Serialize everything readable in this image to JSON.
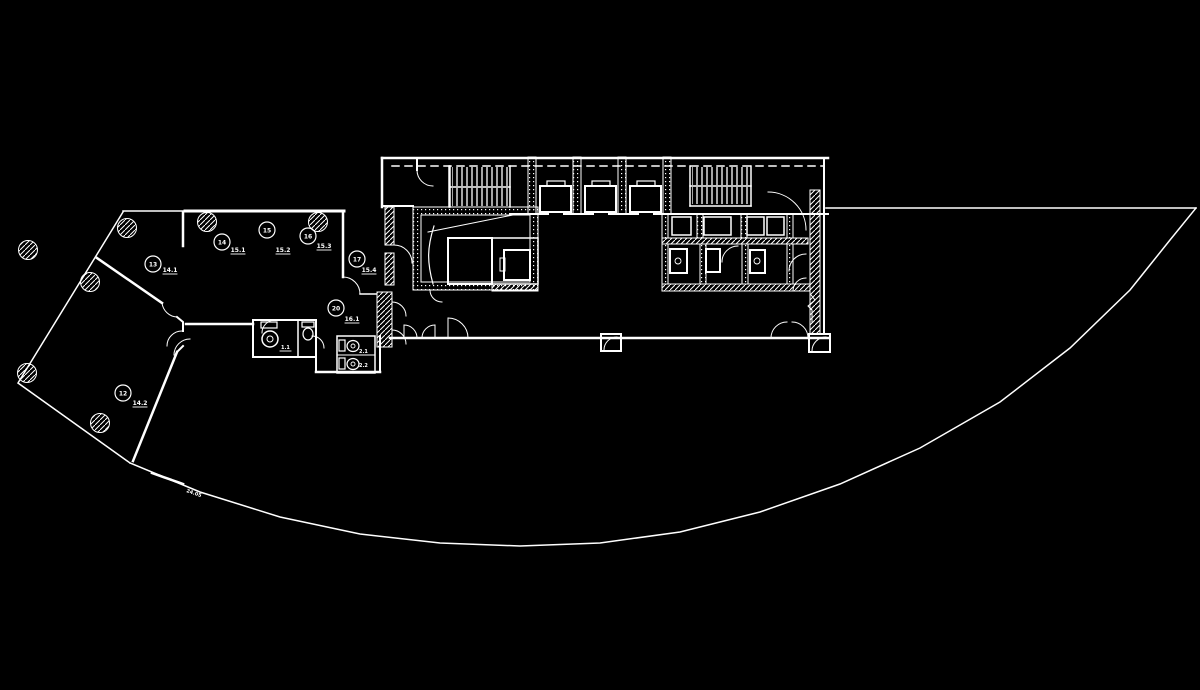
{
  "canvas": {
    "background": "#000000",
    "line_color": "#ffffff"
  },
  "drawing": {
    "kind": "architectural floor plan",
    "view": "plan"
  },
  "room_tags": [
    {
      "tag": "13",
      "area": "14.1"
    },
    {
      "tag": "14",
      "area": "15.1"
    },
    {
      "tag": "15",
      "area": "15.2"
    },
    {
      "tag": "16",
      "area": "15.3"
    },
    {
      "tag": "17",
      "area": "15.4"
    },
    {
      "tag": "20",
      "area": "16.1"
    },
    {
      "tag": "12",
      "area": "14.2"
    }
  ],
  "fixture_labels": [
    "1.1",
    "2.1",
    "2.2"
  ],
  "site": {
    "curve_annotation": "24.05"
  }
}
